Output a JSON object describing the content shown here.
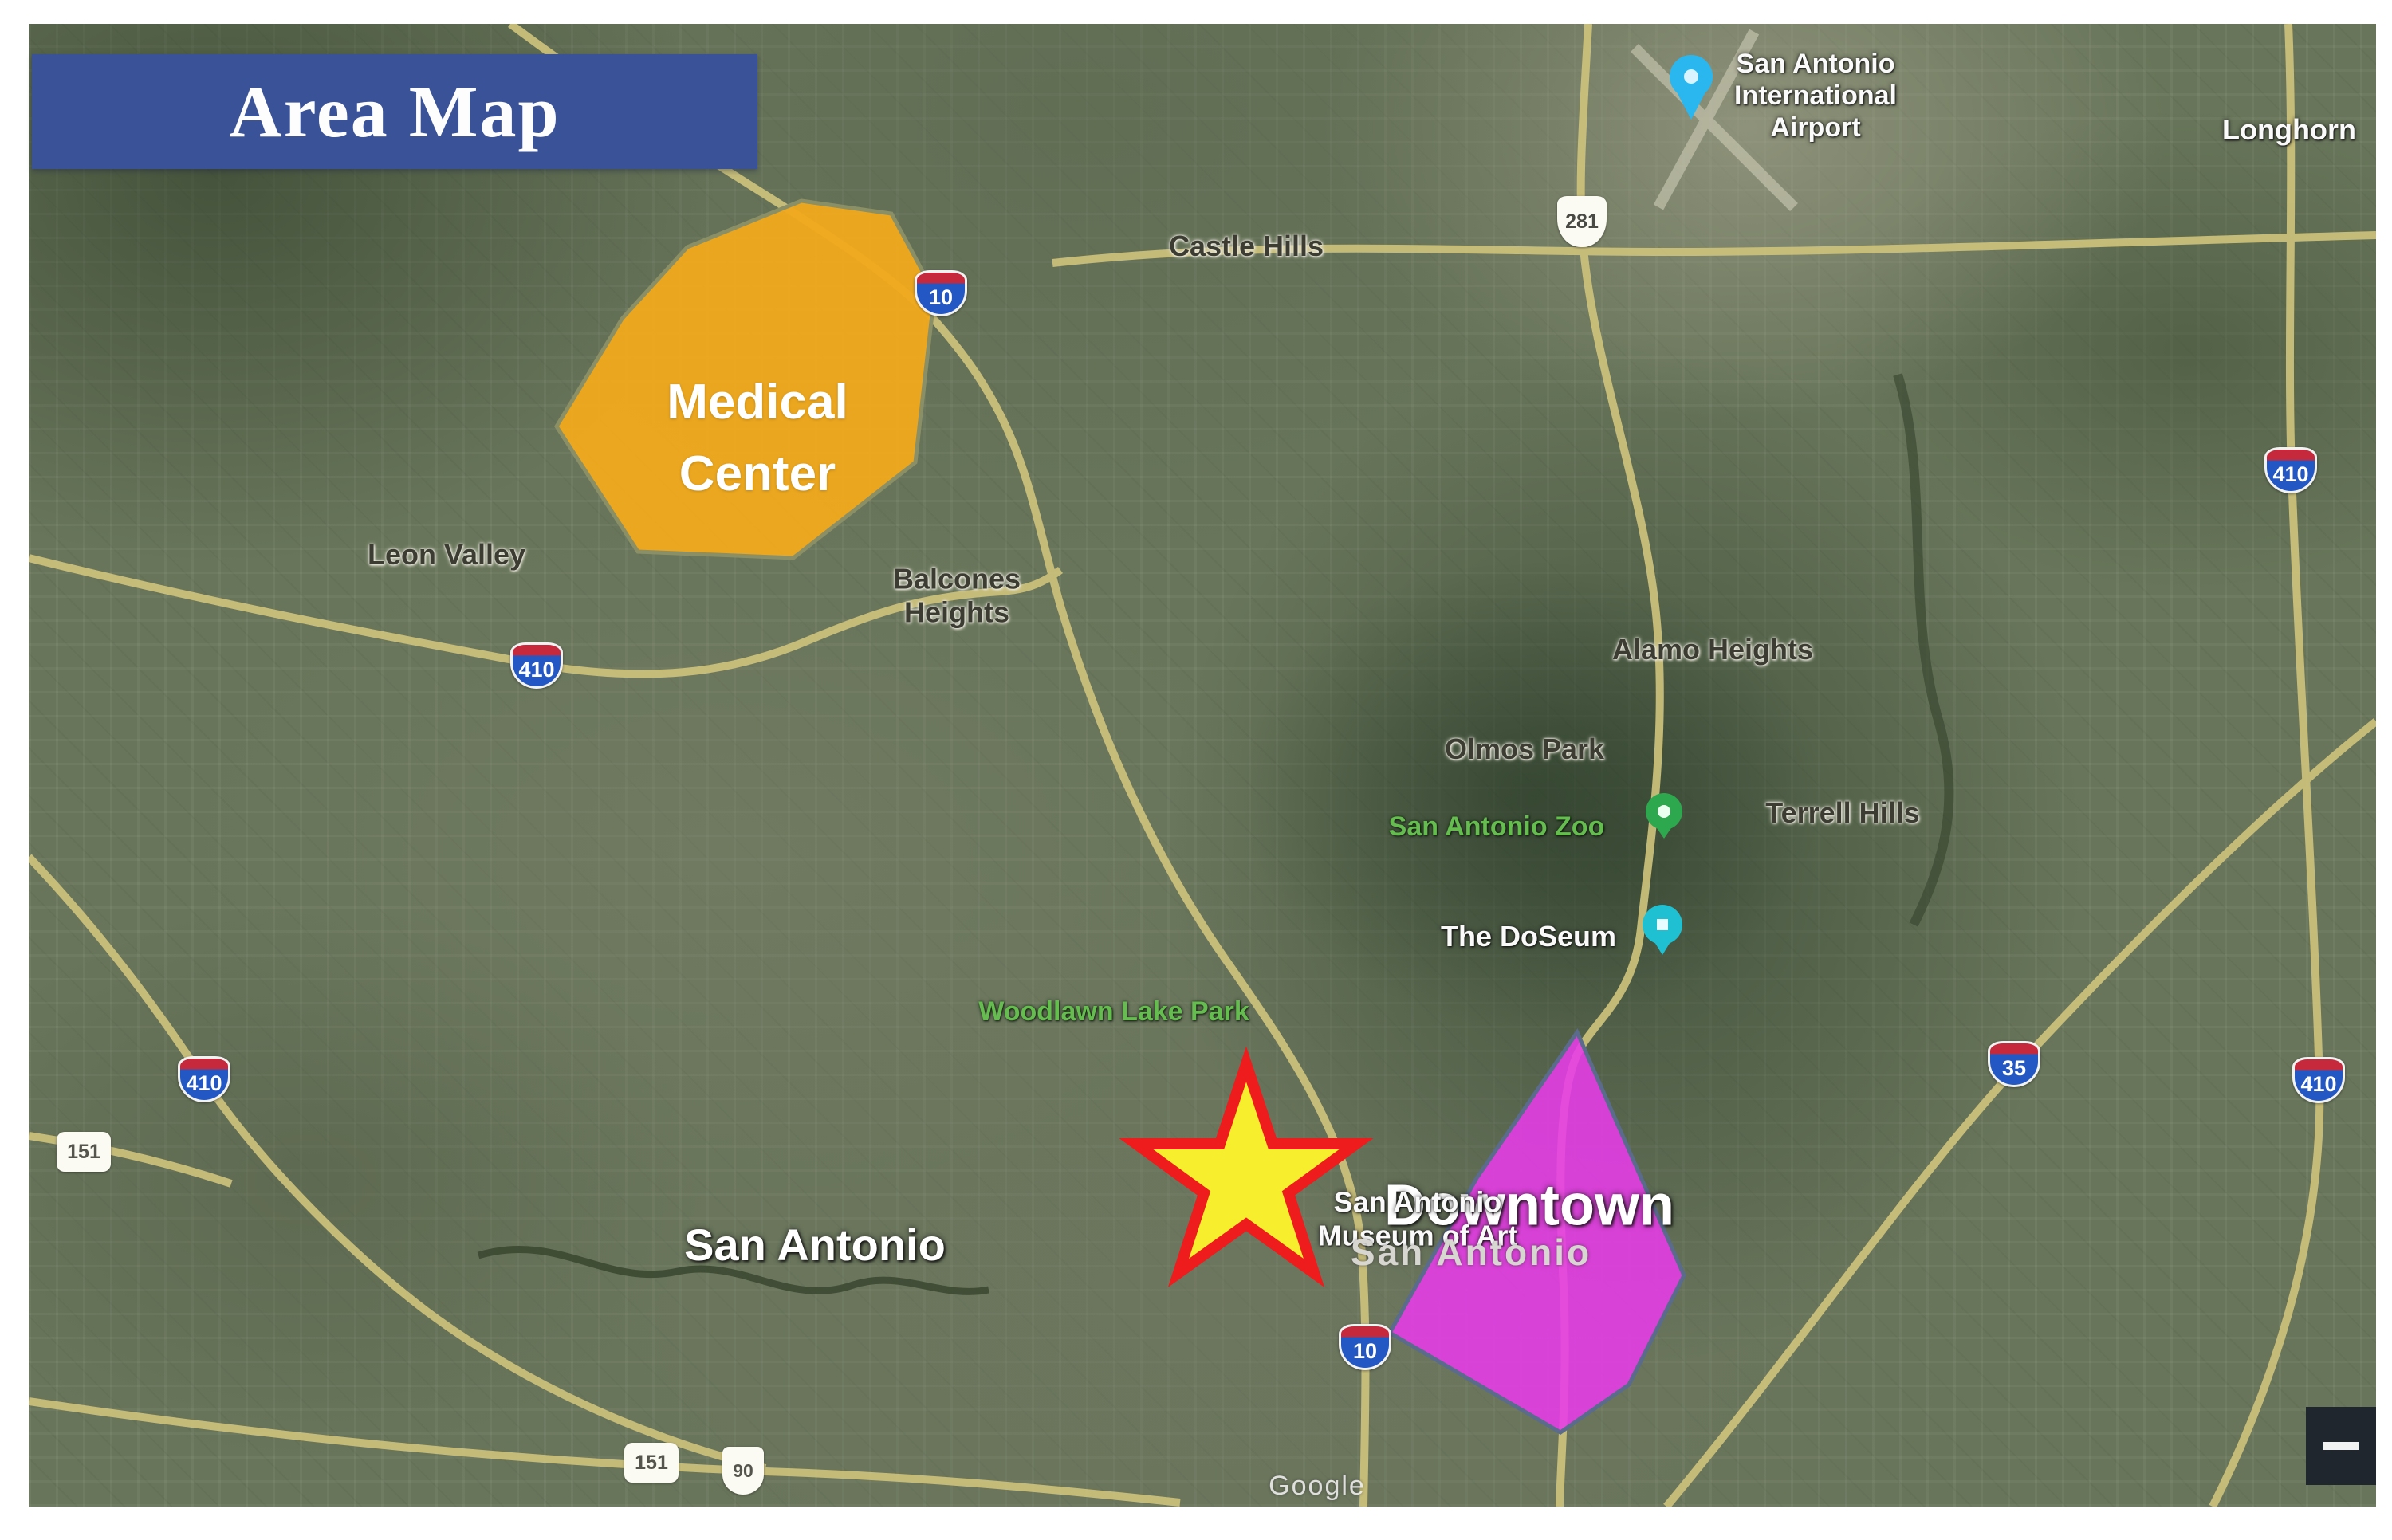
{
  "banner": {
    "title": "Area Map",
    "bg_color": "#3a5298"
  },
  "regions": {
    "medical_center": {
      "line1": "Medical",
      "line2": "Center",
      "fill": "#F0A91D",
      "stroke": "#8a8f66"
    },
    "downtown": {
      "label": "Downtown",
      "fill": "#E83BE8",
      "stroke": "#5a6b8c"
    }
  },
  "star_marker": {
    "fill": "#F7EF2E",
    "stroke": "#EE1C1C"
  },
  "place_labels": {
    "castle_hills": "Castle Hills",
    "leon_valley": "Leon Valley",
    "balcones_heights": {
      "line1": "Balcones",
      "line2": "Heights"
    },
    "alamo_heights": "Alamo Heights",
    "olmos_park": "Olmos Park",
    "terrell_hills": "Terrell Hills",
    "san_antonio_zoo": "San Antonio Zoo",
    "the_doseum": "The DoSeum",
    "woodlawn_lake_park": "Woodlawn Lake Park",
    "museum_of_art": {
      "line1": "San Antonio",
      "line2": "Museum of Art"
    },
    "san_antonio_big": "San Antonio",
    "san_antonio_downtown": "San Antonio",
    "longhorn": "Longhorn",
    "airport": {
      "line1": "San Antonio",
      "line2": "International",
      "line3": "Airport"
    }
  },
  "highway_shields": {
    "i10_nw": "10",
    "i10_south": "10",
    "i410_left": "410",
    "i410_far_left": "410",
    "i410_right_top": "410",
    "i410_right_bottom": "410",
    "i35": "35",
    "us281": "281",
    "us90": "90",
    "sh151_left": "151",
    "sh151_bottom": "151"
  },
  "poi_pins": {
    "airport_pin_color": "#2ab7f0",
    "zoo_pin_color": "#2ea84e",
    "doseum_pin_color": "#1fc0d2"
  },
  "attribution": {
    "text": "Google"
  },
  "controls": {
    "zoom_out": "−"
  }
}
